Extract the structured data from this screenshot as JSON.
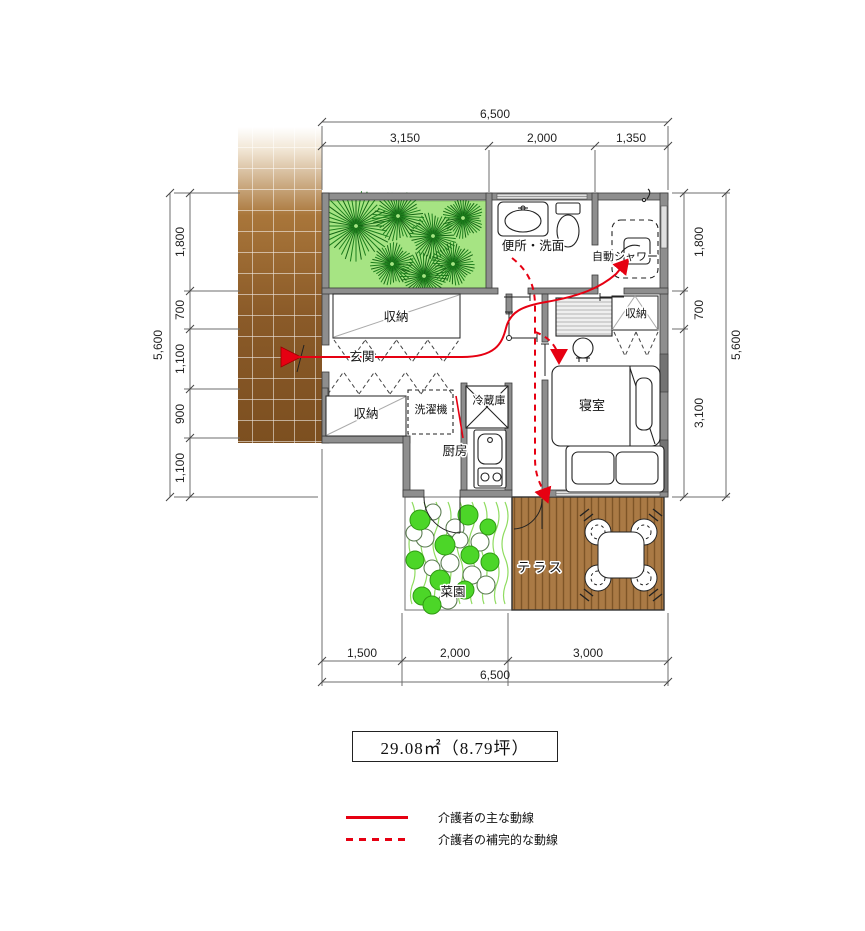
{
  "plan": {
    "rooms": {
      "toilet_washroom": "便所・洗面",
      "auto_shower": "自動シャワー",
      "storage_top": "収納",
      "entrance": "玄関",
      "storage_left": "収納",
      "washer": "洗濯機",
      "fridge": "冷蔵庫",
      "kitchen": "厨房",
      "bedroom": "寝室",
      "storage_bedroom": "収納",
      "vegetable_garden": "菜園",
      "terrace": "テラス"
    },
    "dims": {
      "top": {
        "total": "6,500",
        "segments": [
          "3,150",
          "2,000",
          "1,350"
        ]
      },
      "bottom": {
        "total": "6,500",
        "segments": [
          "1,500",
          "2,000",
          "3,000"
        ]
      },
      "left": {
        "total": "5,600",
        "segments": [
          "1,800",
          "700",
          "1,100",
          "900",
          "1,100"
        ]
      },
      "right": {
        "total": "5,600",
        "segments": [
          "1,800",
          "700",
          "3,100"
        ]
      }
    },
    "area_label": "29.08㎡（8.79坪）",
    "legend": {
      "main": "介護者の主な動線",
      "supplementary": "介護者の補完的な動線"
    },
    "colors": {
      "flow": "#e60012",
      "wall": "#8e8e8e",
      "approach": "#8a5a28",
      "garden": "#a6e483",
      "tree": "#1c7e1c",
      "deck": "#aa7a45",
      "crop": "#4cd628"
    }
  }
}
